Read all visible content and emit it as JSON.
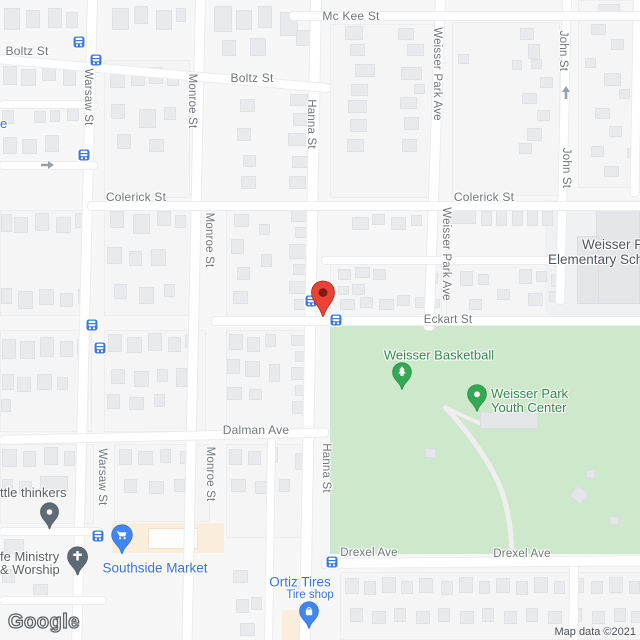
{
  "map": {
    "attribution": "Map data ©2021",
    "google_logo": "Google",
    "colors": {
      "land": "#f7f7f8",
      "road": "#ffffff",
      "park_green": "#cde8cb",
      "commercial_zone": "#fbeedd",
      "building": "#e9eaec",
      "street_label": "#71767b",
      "poi_blue": "#3a71da",
      "poi_green": "#2e8b46",
      "poi_gray": "#5b6165",
      "school_label": "#4e565e",
      "marker_red": "#ea4335",
      "bus_stop_blue": "#3b78dc",
      "pin_green": "#34a853",
      "pin_gray": "#5f6b74"
    },
    "streets": {
      "mckee": "Mc Kee St",
      "boltz": "Boltz St",
      "colerick": "Colerick St",
      "eckart": "Eckart St",
      "dalman": "Dalman Ave",
      "drexel": "Drexel Ave",
      "warsaw": "Warsaw St",
      "monroe": "Monroe St",
      "hanna": "Hanna St",
      "weisser_park_ave": "Weisser Park Ave",
      "john": "John St"
    },
    "pois": {
      "basketball": "Weisser Basketball",
      "youth_center_line1": "Weisser Park",
      "youth_center_line2": "Youth Center",
      "school_line1": "Weisser Pa",
      "school_line2": "Elementary Scho",
      "southside_market": "Southside Market",
      "ortiz_tires": "Ortiz Tires",
      "ortiz_sub": "Tire shop",
      "little_thinkers": "ttle thinkers",
      "ministry_line1": "fe Ministry",
      "ministry_line2": "& Worship",
      "partial_blue": "e"
    }
  }
}
